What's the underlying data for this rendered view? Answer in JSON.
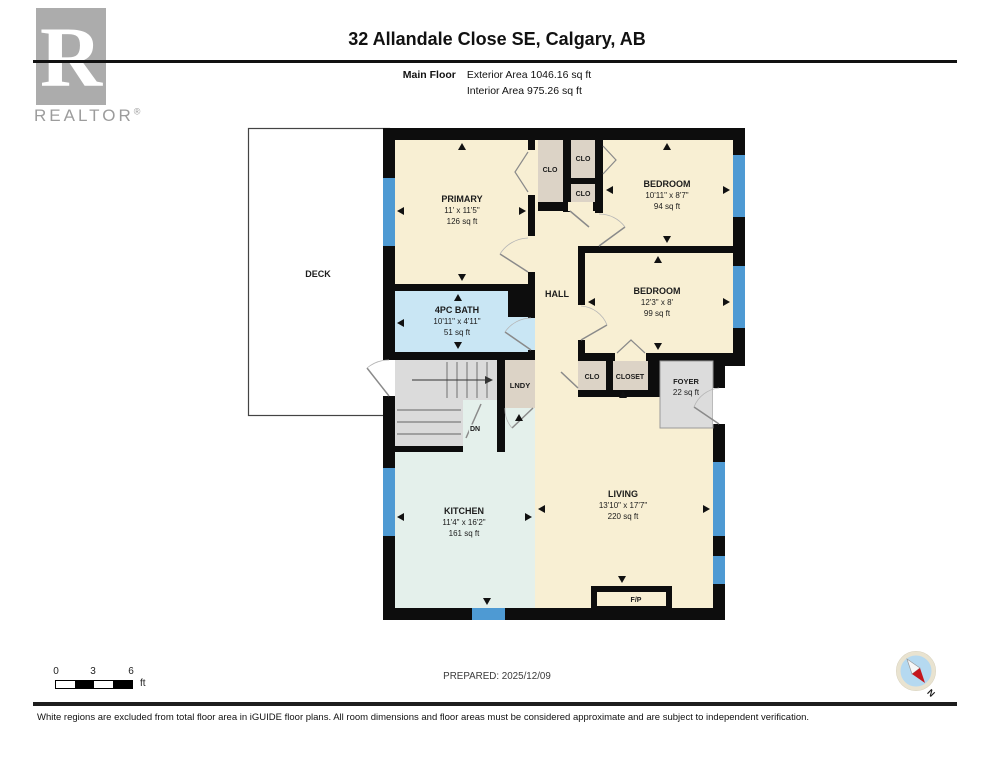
{
  "header": {
    "logo_letter": "R",
    "logo_brand": "REALTOR",
    "logo_reg": "®",
    "title": "32 Allandale Close SE, Calgary, AB",
    "floor_label": "Main Floor",
    "exterior_area": "Exterior Area 1046.16 sq ft",
    "interior_area": "Interior Area 975.26 sq ft"
  },
  "rooms": {
    "deck": {
      "name": "DECK"
    },
    "primary": {
      "name": "PRIMARY",
      "dims": "11' x 11'5\"",
      "area": "126 sq ft"
    },
    "bedroom_top": {
      "name": "BEDROOM",
      "dims": "10'11\" x 8'7\"",
      "area": "94 sq ft"
    },
    "bedroom_mid": {
      "name": "BEDROOM",
      "dims": "12'3\" x 8'",
      "area": "99 sq ft"
    },
    "bath": {
      "name": "4PC BATH",
      "dims": "10'11\" x 4'11\"",
      "area": "51 sq ft"
    },
    "hall": {
      "name": "HALL"
    },
    "kitchen": {
      "name": "KITCHEN",
      "dims": "11'4\" x 16'2\"",
      "area": "161 sq ft"
    },
    "living": {
      "name": "LIVING",
      "dims": "13'10\" x 17'7\"",
      "area": "220 sq ft"
    },
    "foyer": {
      "name": "FOYER",
      "area": "22 sq ft"
    },
    "laundry": {
      "name": "LNDY"
    },
    "clo_primary": {
      "name": "CLO"
    },
    "clo_top": {
      "name": "CLO"
    },
    "clo_mid": {
      "name": "CLO"
    },
    "clo_hall": {
      "name": "CLO"
    },
    "closet_hall": {
      "name": "CLOSET"
    },
    "stairs": {
      "name": "DN"
    },
    "fireplace": {
      "name": "F/P"
    }
  },
  "footer": {
    "scale_ticks": [
      "0",
      "3",
      "6"
    ],
    "scale_unit": "ft",
    "prepared": "PREPARED: 2025/12/09",
    "compass_north": "N",
    "disclaimer": "White regions are excluded from total floor area in iGUIDE floor plans. All room dimensions and floor areas must be considered approximate and are subject to independent verification."
  },
  "colors": {
    "room_cream": "#F8EFD3",
    "bath_blue": "#C9E6F4",
    "kitchen_teal": "#E4F0EB",
    "closet_tan": "#DCD3C6",
    "grey_area": "#DBDBDB",
    "window_blue": "#4E9AD3",
    "wall_black": "#0D0D0D",
    "compass_red": "#C4161C",
    "compass_blue": "#B5D9F0"
  }
}
